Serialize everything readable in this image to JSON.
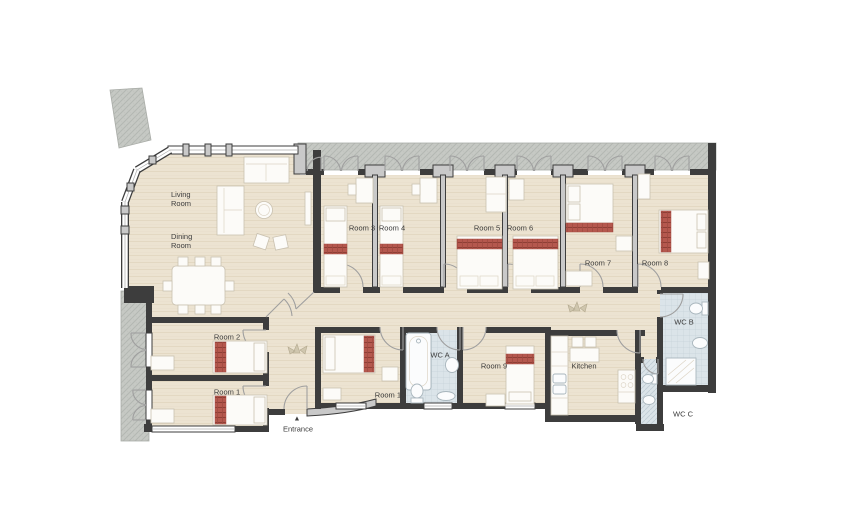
{
  "floor_plan": {
    "labels": {
      "living_room": "Living Room",
      "dining_room": "Dining Room",
      "room_1": "Room 1",
      "room_2": "Room 2",
      "room_3": "Room 3",
      "room_4": "Room 4",
      "room_5": "Room 5",
      "room_6": "Room 6",
      "room_7": "Room 7",
      "room_8": "Room 8",
      "room_9": "Room 9",
      "room_10": "Room 10",
      "wc_a": "WC A",
      "wc_b": "WC B",
      "wc_c": "WC C",
      "kitchen": "Kitchen",
      "entrance": "Entrance"
    },
    "icons": {
      "entrance_marker": "▲"
    },
    "colors": {
      "wood_floor": "#ece3d1",
      "wall_dark": "#3d3d3d",
      "wall_light": "#c9c9c9",
      "exterior_hatch": "#c6c9c4",
      "bathroom_tile": "#dbe4e9",
      "bed_accent_red": "#b5584e",
      "label_text": "#3b3b3b"
    }
  }
}
